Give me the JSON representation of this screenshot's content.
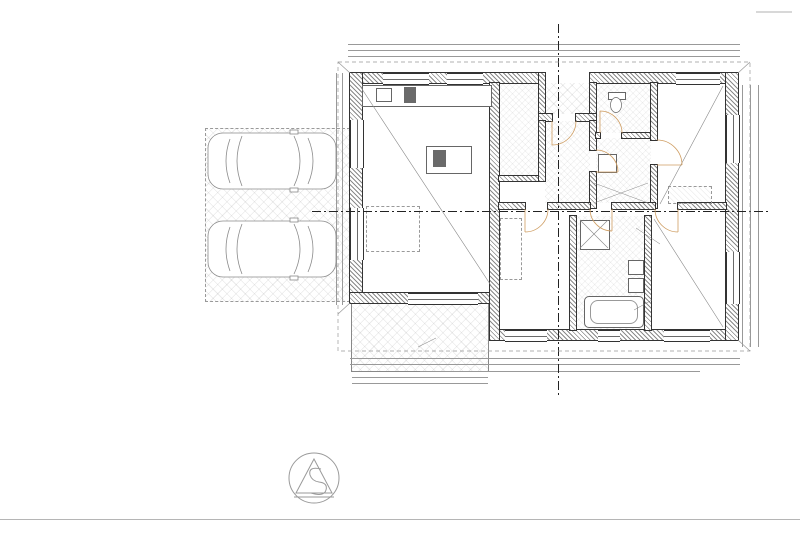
{
  "sheet": {
    "background": "#ffffff",
    "line_color": "#444444",
    "accent_blue": "#2e6da4",
    "door_arc_color": "#cf9e63"
  },
  "legend_materials": {
    "title": "LEGENDA MATERIÁLOV:",
    "items": [
      {
        "sw": "s1",
        "label": "Murivo deliace z tvárnic Ytong P2-500 hr. 125, 100 mm"
      },
      {
        "sw": "s2",
        "label": "Vnútorné nosné murivo na tvárnice Ytong P3-450 hr. 250, 200 mm"
      },
      {
        "sw": "s3",
        "label": "Murivo z tvárnic Ytong P2-400 hr. 300 mm + fasádny zatepľovací systém EPS 80 NSP hr. 150 mm"
      },
      {
        "sw": "s4",
        "label": "Železobetón tr. C20/25 - C16/20"
      },
      {
        "sw": "s5",
        "label": "Tepelná izolácia polystyrén EPS"
      },
      {
        "sw": "s6",
        "label": "Tepelná izolácia XPS 2800 C"
      },
      {
        "sw": "s7",
        "label": "Strešná alebo difúzna fólia stien"
      },
      {
        "sw": "s8",
        "label": "Drevo mäkké ihličnaté"
      },
      {
        "sw": "s9",
        "label": "Tepelná izolácia dosková Isover Unirol Plus"
      },
      {
        "sw": "s10",
        "label": "Prostý betón základových pásov tr. C12/15"
      },
      {
        "sw": "s11",
        "label": "Izolácia proti zemnej vlhkosti V60 S35 1x natavením za studena, strešná difúzna fólia, parozábrana"
      },
      {
        "sw": "s12",
        "label": "Zásyp výkopu zhutnenou zeminou"
      },
      {
        "sw": "s13",
        "label": "Drvené zhutnené kamenivo fr. 0 - 63 hr. 150 mm"
      }
    ]
  },
  "legend_tags": [
    {
      "code": "DZ",
      "sub": "",
      "label": "Dažďový zvod ø 100 mm + PVC lapač nečistôt"
    },
    {
      "code": "RH",
      "sub": "",
      "label": "Domový ELI rozvádzač"
    },
    {
      "code": "TČ",
      "sub": "VM1",
      "label": "TČ NIBE VVM 320 - 180 L"
    },
    {
      "code": "TČ",
      "sub": "OUT1",
      "label": "TČ NIBE F 2040 - 8 kW"
    },
    {
      "code": "SRV",
      "sub": "",
      "label": "Decentrálna rekuperačná jednotka 56 m³/hod. max. 4 x"
    },
    {
      "code": "PV",
      "sub": "",
      "label": "Podkrovný výlez Fakro 660x1200 mm"
    }
  ],
  "legend_rooms": {
    "title": "LEGENDA MIESTNOSTÍ",
    "headers": [
      "Č.M.",
      "NÁZOV MIESTNOSTI",
      "PLOCHA V m²",
      "PODLAHA",
      "ÚPRAVA STIEN",
      "POZNÁMKA"
    ],
    "rows": [
      [
        "1.01",
        "Zádverie",
        "6,26",
        "Keramická dlažba",
        "Keramický sokel v=0,1 m",
        "Štuková omietka"
      ],
      [
        "1.02",
        "Chodba",
        "5,99",
        "Laminátová podlaha",
        "Soklová lišta",
        "Štuková omietka"
      ],
      [
        "1.03",
        "WC",
        "2,66",
        "Keramická dlažba",
        "Keramický obkl. v = 1,50 m",
        "Štuková omietka"
      ],
      [
        "1.04",
        "Obývacia izba + Kuchyňa",
        "37,62",
        "Laminátová podlaha",
        "Soklová lišta, keramický obkl. v = 1,50 m",
        "Štuková omietka"
      ],
      [
        "1.05",
        "Komora",
        "3,93",
        "Keramická dlažba",
        "Keramický sokel v=0,1 m",
        "Štuková omietka"
      ],
      [
        "1.06",
        "Spálňa",
        "12,67",
        "Laminátová podlaha",
        "Soklová lišta",
        "Štuková omietka"
      ],
      [
        "1.07",
        "Kúpeľňa + WC",
        "7,45",
        "Keramická dlažba",
        "Keramický obkl. v = 1,50 - 2,60 m",
        "Štuková omietka"
      ],
      [
        "1.08",
        "Izba",
        "12,66",
        "Laminátová podlaha",
        "Soklová lišta",
        "Štuková omietka"
      ],
      [
        "1.09",
        "Izba",
        "12,34",
        "Laminátová podlaha",
        "Soklová lišta",
        "Štuková omietka"
      ],
      [
        "1.10",
        "TM",
        "2,23",
        "Keramická dlažba",
        "Keramický sokel v=0,1 m",
        "Štuková omietka"
      ],
      [
        "1.11",
        "Terasa",
        "13,65",
        "Betónová dlažba",
        "",
        "Fasádna omietka"
      ],
      [
        "1.12",
        "Závetrie",
        "1,63",
        "Betónová dlažba",
        "",
        "Fasádna omietka"
      ]
    ],
    "totals": [
      [
        "ÚŽITKOVÁ PLOCHA",
        "104,01"
      ],
      [
        "OBYTNÁ PLOCHA",
        "75,49"
      ],
      [
        "ZASTAVANÁ PLOCHA",
        "147,25"
      ]
    ],
    "note": "- s terasou"
  },
  "plan": {
    "texts": [
      {
        "t": "14 030",
        "x": 543,
        "y": 38,
        "c": "d"
      },
      {
        "t": "1 625",
        "x": 377,
        "y": 47,
        "c": "d"
      },
      {
        "t": "1 900",
        "x": 430,
        "y": 47,
        "c": "d"
      },
      {
        "t": "700 (1400)",
        "x": 430,
        "y": 52,
        "c": "ds"
      },
      {
        "t": "1 625",
        "x": 482,
        "y": 47,
        "c": "d"
      },
      {
        "t": "900",
        "x": 520,
        "y": 47,
        "c": "d"
      },
      {
        "t": "900 (1850)",
        "x": 520,
        "y": 52,
        "c": "ds"
      },
      {
        "t": "1 125",
        "x": 549,
        "y": 47,
        "c": "d"
      },
      {
        "t": "1 880",
        "x": 584,
        "y": 47,
        "c": "d"
      },
      {
        "t": "875",
        "x": 615,
        "y": 47,
        "c": "d"
      },
      {
        "t": "900",
        "x": 640,
        "y": 47,
        "c": "d"
      },
      {
        "t": "600 (1900)",
        "x": 640,
        "y": 52,
        "c": "ds"
      },
      {
        "t": "3 830",
        "x": 695,
        "y": 47,
        "c": "d"
      },
      {
        "t": "4 825",
        "x": 415,
        "y": 59,
        "c": "d"
      },
      {
        "t": "125",
        "x": 480,
        "y": 59,
        "c": "ds"
      },
      {
        "t": "1 300",
        "x": 505,
        "y": 59,
        "c": "d"
      },
      {
        "t": "1 630",
        "x": 562,
        "y": 59,
        "c": "d"
      },
      {
        "t": "4 650",
        "x": 680,
        "y": 59,
        "c": "d"
      },
      {
        "t": "300",
        "x": 726,
        "y": 59,
        "c": "ds"
      },
      {
        "t": "300",
        "x": 745,
        "y": 101,
        "c": "d",
        "r": -90
      },
      {
        "t": "1 680",
        "x": 745,
        "y": 131,
        "c": "d",
        "r": -90
      },
      {
        "t": "4 325",
        "x": 745,
        "y": 218,
        "c": "d",
        "r": -90
      },
      {
        "t": "1 650",
        "x": 745,
        "y": 294,
        "c": "d",
        "r": -90
      },
      {
        "t": "3 170",
        "x": 745,
        "y": 327,
        "c": "d",
        "r": -90
      },
      {
        "t": "1 350 (900)",
        "x": 754,
        "y": 204,
        "c": "ds",
        "r": -90
      },
      {
        "t": "9 470",
        "x": 763,
        "y": 216,
        "c": "d",
        "r": -90
      },
      {
        "t": "1 880",
        "x": 438,
        "y": 361,
        "c": "d"
      },
      {
        "t": "875",
        "x": 470,
        "y": 361,
        "c": "d"
      },
      {
        "t": "1 018",
        "x": 496,
        "y": 361,
        "c": "d"
      },
      {
        "t": "1 500",
        "x": 538,
        "y": 361,
        "c": "d"
      },
      {
        "t": "1 445",
        "x": 597,
        "y": 361,
        "c": "d"
      },
      {
        "t": "1 280",
        "x": 646,
        "y": 361,
        "c": "d"
      },
      {
        "t": "3 950",
        "x": 690,
        "y": 361,
        "c": "d"
      },
      {
        "t": "300",
        "x": 727,
        "y": 361,
        "c": "ds"
      },
      {
        "t": "2 250 (0)",
        "x": 438,
        "y": 367,
        "c": "ds"
      },
      {
        "t": "1 350 (900)",
        "x": 538,
        "y": 367,
        "c": "ds"
      },
      {
        "t": "600 (1650)",
        "x": 646,
        "y": 367,
        "c": "ds"
      },
      {
        "t": "9 105",
        "x": 560,
        "y": 374,
        "c": "d"
      },
      {
        "t": "4 825",
        "x": 420,
        "y": 379,
        "c": "d"
      },
      {
        "t": "2 250",
        "x": 420,
        "y": 385,
        "c": "d"
      },
      {
        "t": "3 000",
        "x": 339,
        "y": 112,
        "c": "d",
        "r": -90
      },
      {
        "t": "1 300",
        "x": 333,
        "y": 155,
        "c": "ds",
        "r": -90
      },
      {
        "t": "7 575",
        "x": 339,
        "y": 196,
        "c": "d",
        "r": -90
      },
      {
        "t": "4 175",
        "x": 339,
        "y": 258,
        "c": "d",
        "r": -90
      },
      {
        "t": "3 748",
        "x": 452,
        "y": 150,
        "c": "di",
        "r": -90
      },
      {
        "t": "3 148",
        "x": 468,
        "y": 150,
        "c": "di",
        "r": -90
      },
      {
        "t": "1 425",
        "x": 512,
        "y": 192,
        "c": "di"
      },
      {
        "t": "2 886",
        "x": 560,
        "y": 192,
        "c": "di"
      },
      {
        "t": "2 680",
        "x": 634,
        "y": 192,
        "c": "di"
      },
      {
        "t": "2 425",
        "x": 505,
        "y": 262,
        "c": "di",
        "r": -90
      },
      {
        "t": "3 725",
        "x": 566,
        "y": 262,
        "c": "di",
        "r": -90
      },
      {
        "t": "700 / 1 970",
        "x": 529,
        "y": 117,
        "c": "b",
        "r": -90
      },
      {
        "t": "900 / 2 020",
        "x": 566,
        "y": 128,
        "c": "b"
      },
      {
        "t": "700 / 1 970",
        "x": 611,
        "y": 126,
        "c": "b"
      },
      {
        "t": "700 / 1 970",
        "x": 604,
        "y": 181,
        "c": "b"
      },
      {
        "t": "800 / 1 970",
        "x": 536,
        "y": 221,
        "c": "b"
      },
      {
        "t": "700 / 1 970",
        "x": 600,
        "y": 221,
        "c": "b"
      },
      {
        "t": "800 / 1 970",
        "x": 665,
        "y": 221,
        "c": "b"
      },
      {
        "t": "800 / 1 970",
        "x": 657,
        "y": 152,
        "c": "b",
        "r": -90
      },
      {
        "t": "SRV",
        "x": 655,
        "y": 95,
        "c": "srv",
        "r": -90
      },
      {
        "t": "SRV",
        "x": 470,
        "y": 280,
        "c": "srv",
        "r": -90
      },
      {
        "t": "SRV",
        "x": 577,
        "y": 318,
        "c": "srv",
        "r": -90
      },
      {
        "t": "SRV",
        "x": 688,
        "y": 318,
        "c": "srv",
        "r": -90
      },
      {
        "t": "ŽB preklad dl. 1800/v.250 mm",
        "x": 678,
        "y": 243,
        "c": "g"
      },
      {
        "t": "ŽB prievlak v. 400 mm",
        "x": 404,
        "y": 349,
        "c": "g"
      },
      {
        "t": "VZT rozvod vzduchu + potrubie",
        "x": 402,
        "y": 112,
        "c": "g"
      },
      {
        "t": "ZTI",
        "x": 650,
        "y": 302,
        "c": "g"
      },
      {
        "t": "1.01",
        "x": 564,
        "y": 164,
        "c": "r"
      },
      {
        "t": "1.02",
        "x": 563,
        "y": 197,
        "c": "r"
      },
      {
        "t": "1.03",
        "x": 618,
        "y": 107,
        "c": "r"
      },
      {
        "t": "1.04",
        "x": 399,
        "y": 162,
        "c": "r"
      },
      {
        "t": "1.05",
        "x": 507,
        "y": 120,
        "c": "r"
      },
      {
        "t": "1.06",
        "x": 536,
        "y": 269,
        "c": "r"
      },
      {
        "t": "1.07",
        "x": 610,
        "y": 276,
        "c": "r"
      },
      {
        "t": "1.08",
        "x": 682,
        "y": 277,
        "c": "r"
      },
      {
        "t": "1.09",
        "x": 686,
        "y": 137,
        "c": "r"
      },
      {
        "t": "1.10",
        "x": 620,
        "y": 162,
        "c": "r"
      },
      {
        "t": "1.11",
        "x": 430,
        "y": 312,
        "c": "r"
      },
      {
        "t": "1.12",
        "x": 564,
        "y": 85,
        "c": "r"
      },
      {
        "t": "s.v. 2,600",
        "x": 400,
        "y": 180,
        "c": "sv"
      },
      {
        "t": "s.v. 2,600",
        "x": 565,
        "y": 181,
        "c": "sv"
      },
      {
        "t": "s.v. 2,600",
        "x": 536,
        "y": 289,
        "c": "sv"
      }
    ],
    "boxes": [
      {
        "l": [
          "RT: -0,580 = 281,72",
          "UT: -0,300 = 282,00"
        ],
        "x": 392,
        "y": 62
      },
      {
        "l": [
          "-0,350"
        ],
        "x": 524,
        "y": 60
      },
      {
        "l": [
          "-0,125"
        ],
        "x": 556,
        "y": 74
      },
      {
        "l": [
          "TČ out1"
        ],
        "x": 624,
        "y": 60,
        "dashed": true
      },
      {
        "l": [
          "RT: -0,180 = 282,20",
          "UT: -0,360 = 282,00"
        ],
        "x": 700,
        "y": 63
      },
      {
        "l": [
          "Dz"
        ],
        "x": 349,
        "y": 63
      },
      {
        "l": [
          "Dz"
        ],
        "x": 733,
        "y": 65
      },
      {
        "l": [
          "RT: -0,350 = 281,95",
          "UT: -0,350 = 282,00"
        ],
        "x": 400,
        "y": 309
      },
      {
        "l": [
          "RT: -0,390 = 281,92",
          "UT: -0,300 = 282,20"
        ],
        "x": 374,
        "y": 347
      },
      {
        "l": [
          "RT: -0,160 = 282,48",
          "UT: -0,300 = 282,00"
        ],
        "x": 762,
        "y": 356
      },
      {
        "l": [
          "-0,150"
        ],
        "x": 266,
        "y": 206
      },
      {
        "l": [
          "± 0,00"
        ],
        "x": 400,
        "y": 172
      },
      {
        "l": [
          "± 0,00"
        ],
        "x": 565,
        "y": 173
      },
      {
        "l": [
          "± 0,00"
        ],
        "x": 536,
        "y": 280
      },
      {
        "l": [
          "- 0,080"
        ],
        "x": 564,
        "y": 93
      },
      {
        "l": [
          "Práčka"
        ],
        "x": 611,
        "y": 149
      },
      {
        "l": [
          "TČ VM1"
        ],
        "x": 635,
        "y": 149
      },
      {
        "l": [
          "RH"
        ],
        "x": 633,
        "y": 177
      },
      {
        "l": [
          "PV"
        ],
        "x": 562,
        "y": 153
      }
    ],
    "markers": [
      {
        "t": "A",
        "x": 558,
        "y": 16,
        "dir": "down"
      },
      {
        "t": "A",
        "x": 557,
        "y": 404,
        "dir": "up"
      },
      {
        "t": "B",
        "x": 303,
        "y": 211,
        "dir": "right"
      },
      {
        "t": "B",
        "x": 777,
        "y": 211,
        "dir": "left"
      }
    ]
  }
}
